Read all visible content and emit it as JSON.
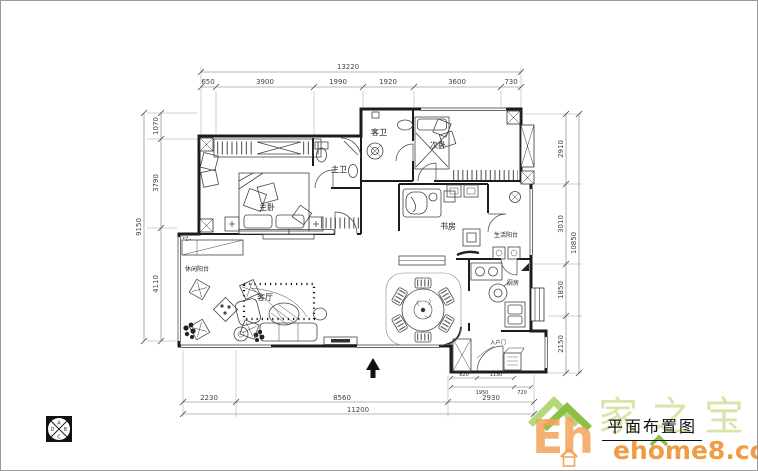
{
  "title": {
    "drawing_label": "平面布置图"
  },
  "watermark": {
    "letters": "Eh",
    "brand": "家之宝",
    "site": "ehome8.com",
    "green": "#8bbf4a",
    "light_green": "#dbe2a6",
    "orange": "#f3a45b"
  },
  "compass": {
    "top": "A",
    "right": "B",
    "bottom": "C",
    "left": "D"
  },
  "rooms": {
    "master_bedroom": "主卧",
    "master_bath": "主卫",
    "guest_bath": "客卫",
    "second_bedroom": "次卧",
    "study": "书房",
    "utility_balcony": "生活阳台",
    "leisure_balcony": "休闲阳台",
    "living_room": "客厅",
    "kitchen": "厨房",
    "entry_door_note": "入户门"
  },
  "dims": {
    "top": {
      "overall": "13220",
      "segments": [
        "650",
        "3900",
        "1990",
        "1920",
        "3600",
        "730"
      ]
    },
    "left": {
      "overall": "9150",
      "segments": [
        "1070",
        "3790",
        "4110"
      ]
    },
    "right": {
      "overall": "10850",
      "segments": [
        "2910",
        "3010",
        "1850",
        "2150"
      ]
    },
    "bottom": {
      "overall": "11200",
      "segments": [
        "2230",
        "8560",
        "2930"
      ]
    },
    "entry_detail": {
      "row1": [
        "820",
        "1130"
      ],
      "row2": [
        "1950",
        "720"
      ]
    }
  }
}
